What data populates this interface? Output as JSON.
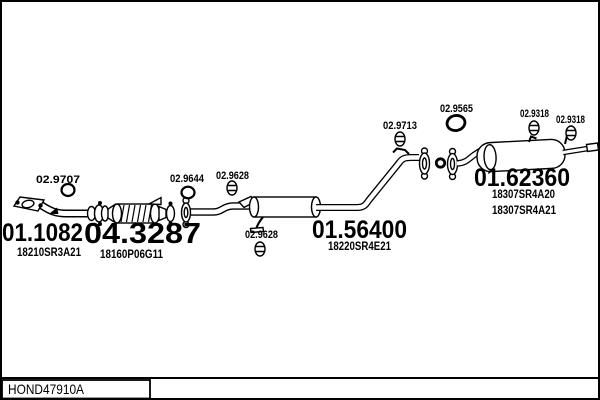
{
  "diagram": {
    "drawing_code": "HOND47910A",
    "colors": {
      "ink": "#000000",
      "background": "#ffffff"
    },
    "parts": [
      {
        "name": "front-pipe",
        "code": "01.1082",
        "oem": "18210SR3A21"
      },
      {
        "name": "catalytic-converter",
        "code": "04.3287",
        "oem": "18160P06G11"
      },
      {
        "name": "centre-muffler",
        "code": "01.56400",
        "oem": "18220SR4E21"
      },
      {
        "name": "rear-muffler",
        "code": "01.62360",
        "oem": "18307SR4A20",
        "oem_alt": "18307SR4A21"
      }
    ],
    "fittings": [
      {
        "name": "gasket-front-pipe",
        "code": "02.9707",
        "type": "gasket-ring"
      },
      {
        "name": "gasket-centre-pipe",
        "code": "02.9644",
        "type": "gasket-ring"
      },
      {
        "name": "rubber-hanger-centre-top",
        "code": "02.9628",
        "type": "rubber-hanger"
      },
      {
        "name": "rubber-hanger-centre-bottom",
        "code": "02.9628",
        "type": "rubber-hanger"
      },
      {
        "name": "rubber-hanger-rear-pipe",
        "code": "02.9713",
        "type": "rubber-hanger"
      },
      {
        "name": "gasket-rear-muffler",
        "code": "02.9565",
        "type": "gasket-ring"
      },
      {
        "name": "rubber-hanger-rear-1",
        "code": "02.9318",
        "type": "rubber-hanger"
      },
      {
        "name": "rubber-hanger-rear-2",
        "code": "02.9318",
        "type": "rubber-hanger"
      }
    ]
  }
}
